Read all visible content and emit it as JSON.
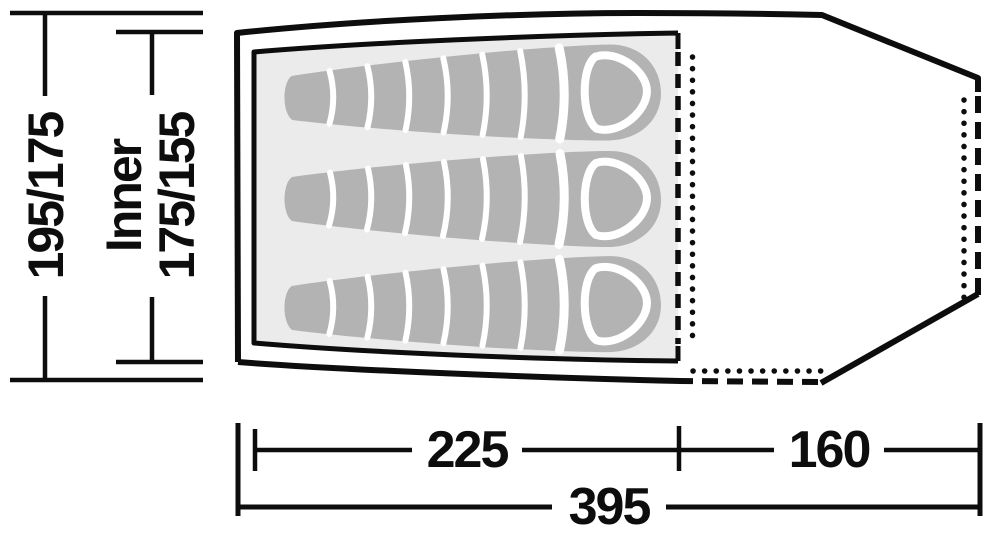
{
  "diagram": {
    "title": "tent-floorplan-top-view",
    "labels": {
      "outer_width": "195/175",
      "inner_label": "Inner",
      "inner_width": "175/155",
      "inner_length": "225",
      "porch_length": "160",
      "total_length": "395"
    },
    "colors": {
      "line": "#0d0d0d",
      "inner_fill": "#ebebeb",
      "bag_fill": "#b3b3b3",
      "divider": "#ffffff",
      "background": "#ffffff"
    },
    "measurements": {
      "outer_width_cm": "195/175",
      "inner_width_cm": "175/155",
      "inner_length_cm": "225",
      "porch_length_cm": "160",
      "total_length_cm": "395"
    },
    "sleeping_bags_count": 3
  }
}
